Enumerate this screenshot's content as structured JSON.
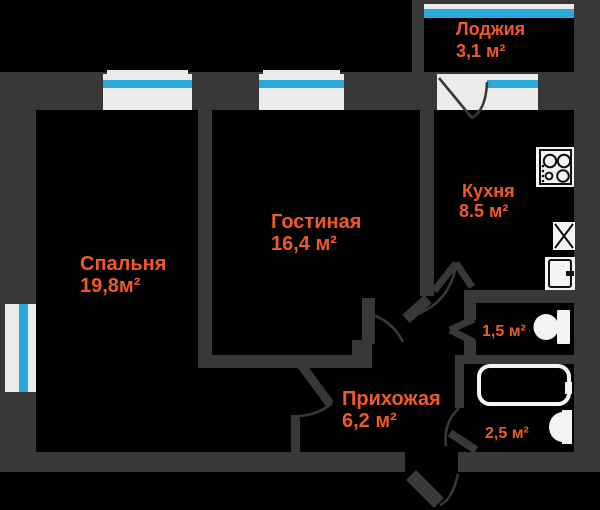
{
  "plan": {
    "colors": {
      "bg": "#000000",
      "wall": "#383838",
      "accent": "#f05a24",
      "winblue": "#2aa9da",
      "winwhite": "#ececec",
      "iconwhite": "#f4f4f4"
    },
    "rooms": {
      "loggia": {
        "name": "Лоджия",
        "area": "3,1 м²"
      },
      "kitchen": {
        "name": "Кухня",
        "area": "8.5 м²"
      },
      "living": {
        "name": "Гостиная",
        "area": "16,4 м²"
      },
      "bedroom": {
        "name": "Спальня",
        "area": "19,8м²"
      },
      "hallway": {
        "name": "Прихожая",
        "area": "6,2 м²"
      },
      "wc": {
        "area": "1,5 м²"
      },
      "bathroom": {
        "area": "2,5 м²"
      }
    },
    "icons": {
      "stove": "stove-icon",
      "sink": "sink-icon",
      "fridge": "fridge-icon",
      "toilet": "toilet-icon",
      "bathtub": "bathtub-icon",
      "washbasin": "washbasin-icon"
    }
  }
}
